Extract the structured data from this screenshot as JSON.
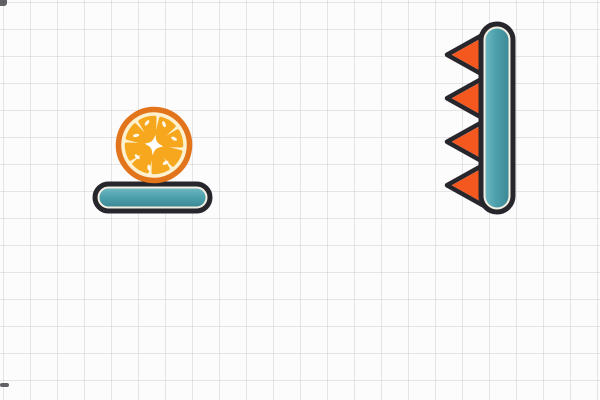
{
  "scene": {
    "name": "physics-puzzle-level",
    "background": "graph-paper-grid",
    "grid_cell_px": 27,
    "objects": {
      "orange": {
        "label": "orange fruit slice",
        "segments": 8,
        "resting_on": "teal platform"
      },
      "platform": {
        "label": "teal platform (horizontal capsule)"
      },
      "spiked_bar": {
        "label": "vertical teal bar with spikes",
        "spike_count": 4,
        "spike_direction": "left"
      }
    }
  },
  "colors": {
    "paper": "#fdfcfc",
    "outline": "#26262c",
    "inner_rim": "#f3efe3",
    "teal_light": "#6cb6c0",
    "teal_mid": "#4ca0ac",
    "teal_dark": "#3d8995",
    "spike_fill": "#f4581f",
    "orange_rind": "#e2741b",
    "orange_pith": "#fdf1cf",
    "orange_pulp": "#f6a71d",
    "sparkle": "#ffffff"
  }
}
